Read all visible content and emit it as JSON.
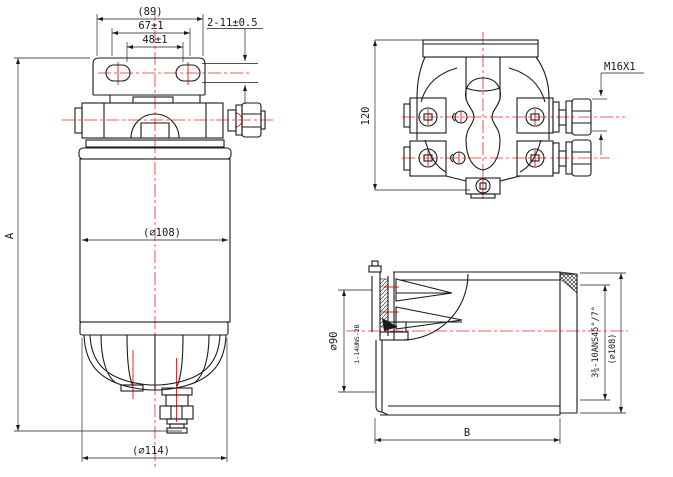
{
  "drawing": {
    "colors": {
      "line": "#1a1a1a",
      "centerline": "#ff2222",
      "background": "#ffffff"
    },
    "front_view": {
      "dim_overall_width": "(89)",
      "dim_hole_span": "67±1",
      "dim_hole_span_inner": "48±1",
      "dim_slots": "2-11±0.5",
      "dim_height": "A",
      "dim_body_diameter": "(∅108)",
      "dim_bowl_diameter": "(∅114)"
    },
    "top_view": {
      "dim_depth": "120",
      "dim_port_thread": "M16X1"
    },
    "side_view": {
      "dim_seal_diameter": "∅90",
      "dim_center_thread": "1-14UNS-2B",
      "dim_seam_spec": "3¾-10ANS45°/7°",
      "dim_shell_diameter": "(∅108)",
      "dim_length": "B"
    }
  }
}
